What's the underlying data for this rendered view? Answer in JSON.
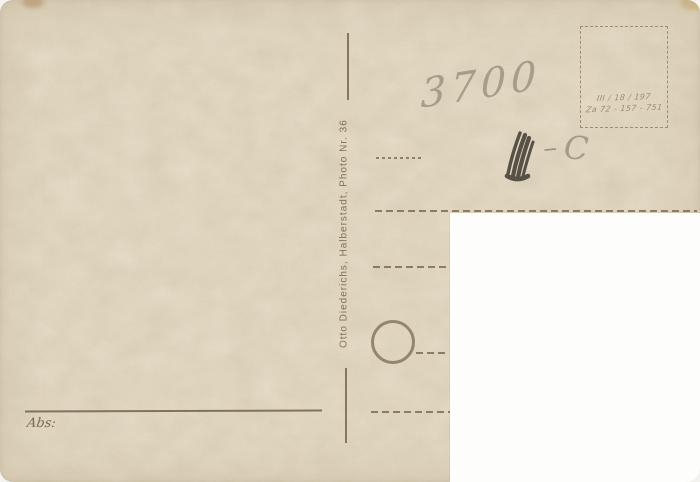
{
  "postcard": {
    "publisher_imprint": "Otto Diederichs, Halberstadt, Photo Nr. 36",
    "sender_label": "Abs:",
    "stamp_box": {
      "print_code_line1": "III / 18 / 197",
      "print_code_line2": "Za 72 - 157 - 751"
    },
    "handwriting": {
      "number": "3700",
      "dash": "–",
      "letter": "C"
    },
    "colors": {
      "paper": "#ebe1cc",
      "printed_ink": "#8b7a62",
      "pencil_light": "#8f8576",
      "pencil_dark": "#454038",
      "cutout_white": "#fdfdfb"
    }
  }
}
